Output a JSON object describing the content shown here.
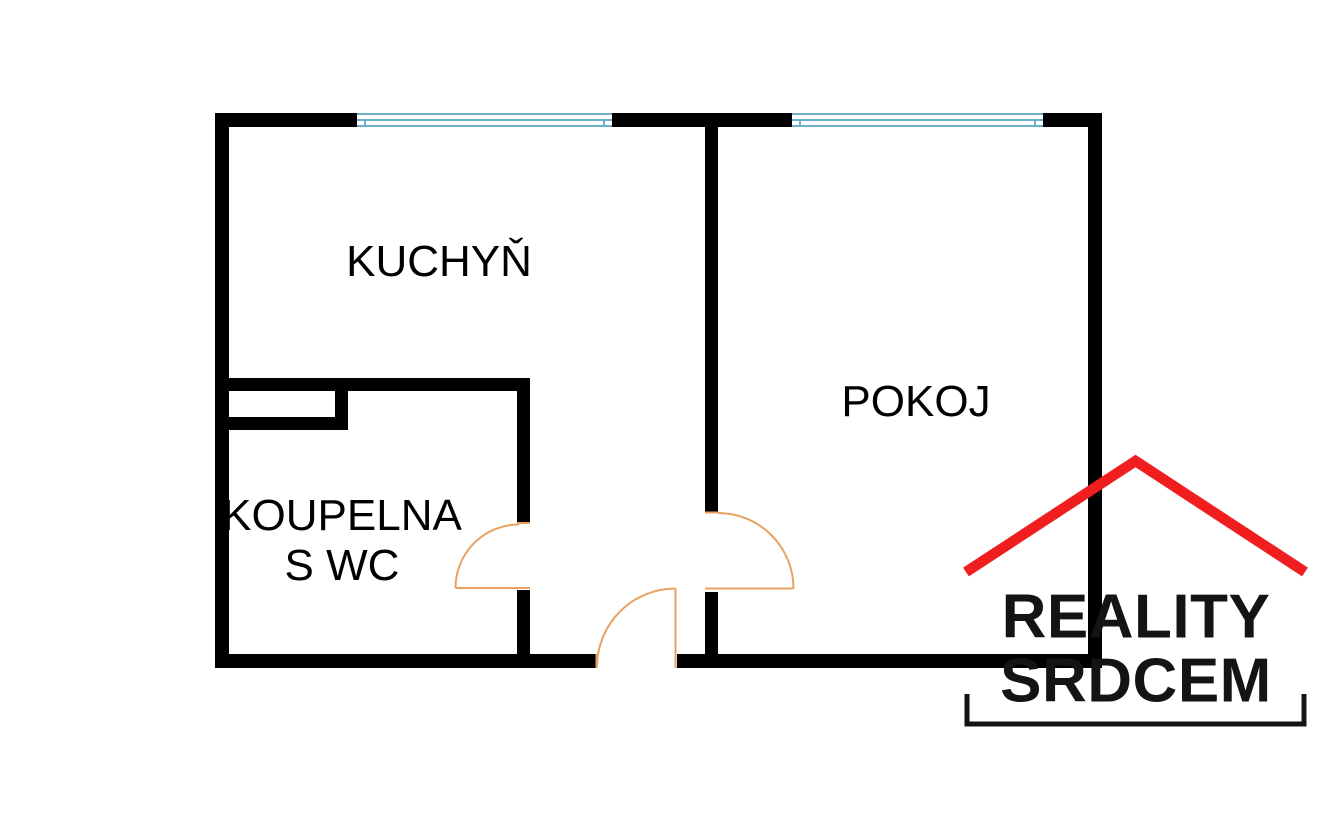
{
  "floorplan": {
    "rooms": [
      {
        "id": "kitchen",
        "label": "KUCHYŇ"
      },
      {
        "id": "room",
        "label": "POKOJ"
      },
      {
        "id": "bathroom",
        "label": "KOUPELNA",
        "label2": "S WC"
      }
    ],
    "features": {
      "windows": 2,
      "doors": 3
    },
    "colors": {
      "wall": "#000000",
      "window": "#6FAEC7",
      "door": "#E8A262",
      "label_text": "#000000",
      "background": "#FFFFFF"
    }
  },
  "logo": {
    "line1": "REALITY",
    "line2": "SRDCEM",
    "colors": {
      "roof": "#F01E1E",
      "text": "#141414",
      "bracket": "#141414"
    },
    "icons": [
      {
        "name": "roof-icon",
        "shape": "red chevron roof"
      },
      {
        "name": "bracket-icon",
        "shape": "bottom square bracket"
      }
    ]
  }
}
